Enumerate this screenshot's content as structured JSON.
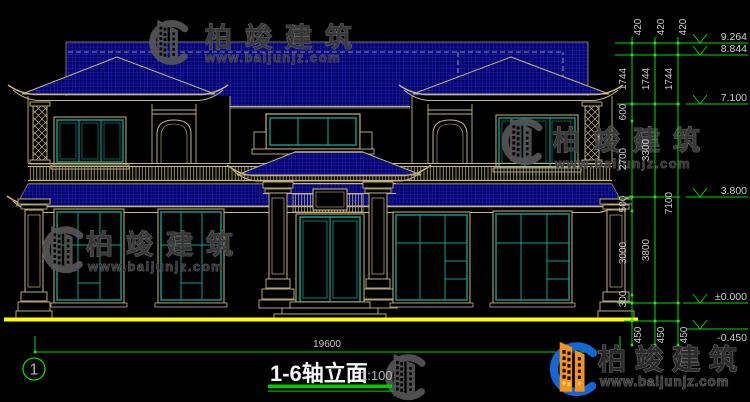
{
  "drawing": {
    "title": "1-6轴立面",
    "scale": "1:100",
    "axis_bubble": "1",
    "overall_width_dim": "19600"
  },
  "elevation_marks": {
    "ridge_top": "9.264",
    "ridge_lower": "8.844",
    "eave": "7.100",
    "second_floor": "3.800",
    "ground_floor": "±0.000",
    "site_ground": "-0.450"
  },
  "dim_segments": {
    "s420": "420",
    "s1744": "1744",
    "s600": "600",
    "s2700": "2700",
    "s500": "500",
    "s3000": "3000",
    "s300": "300",
    "s3300": "3300",
    "s3800": "3800",
    "s7100": "7100",
    "s450": "450"
  },
  "watermark": {
    "brand": "柏竣建筑",
    "url": "www.baijunjz.com"
  },
  "colors": {
    "background": "#000000",
    "roof_blue": "#04046C",
    "roof_grid": "#2B2BD0",
    "line_tan": "#C6B67A",
    "window_teal": "#0EA193",
    "dim_green": "#00DD00",
    "ground_yellow": "#FFFF00",
    "text_gray": "#C9C9C9",
    "logo_blue": "#1468D4",
    "logo_orange": "#F6921E"
  }
}
